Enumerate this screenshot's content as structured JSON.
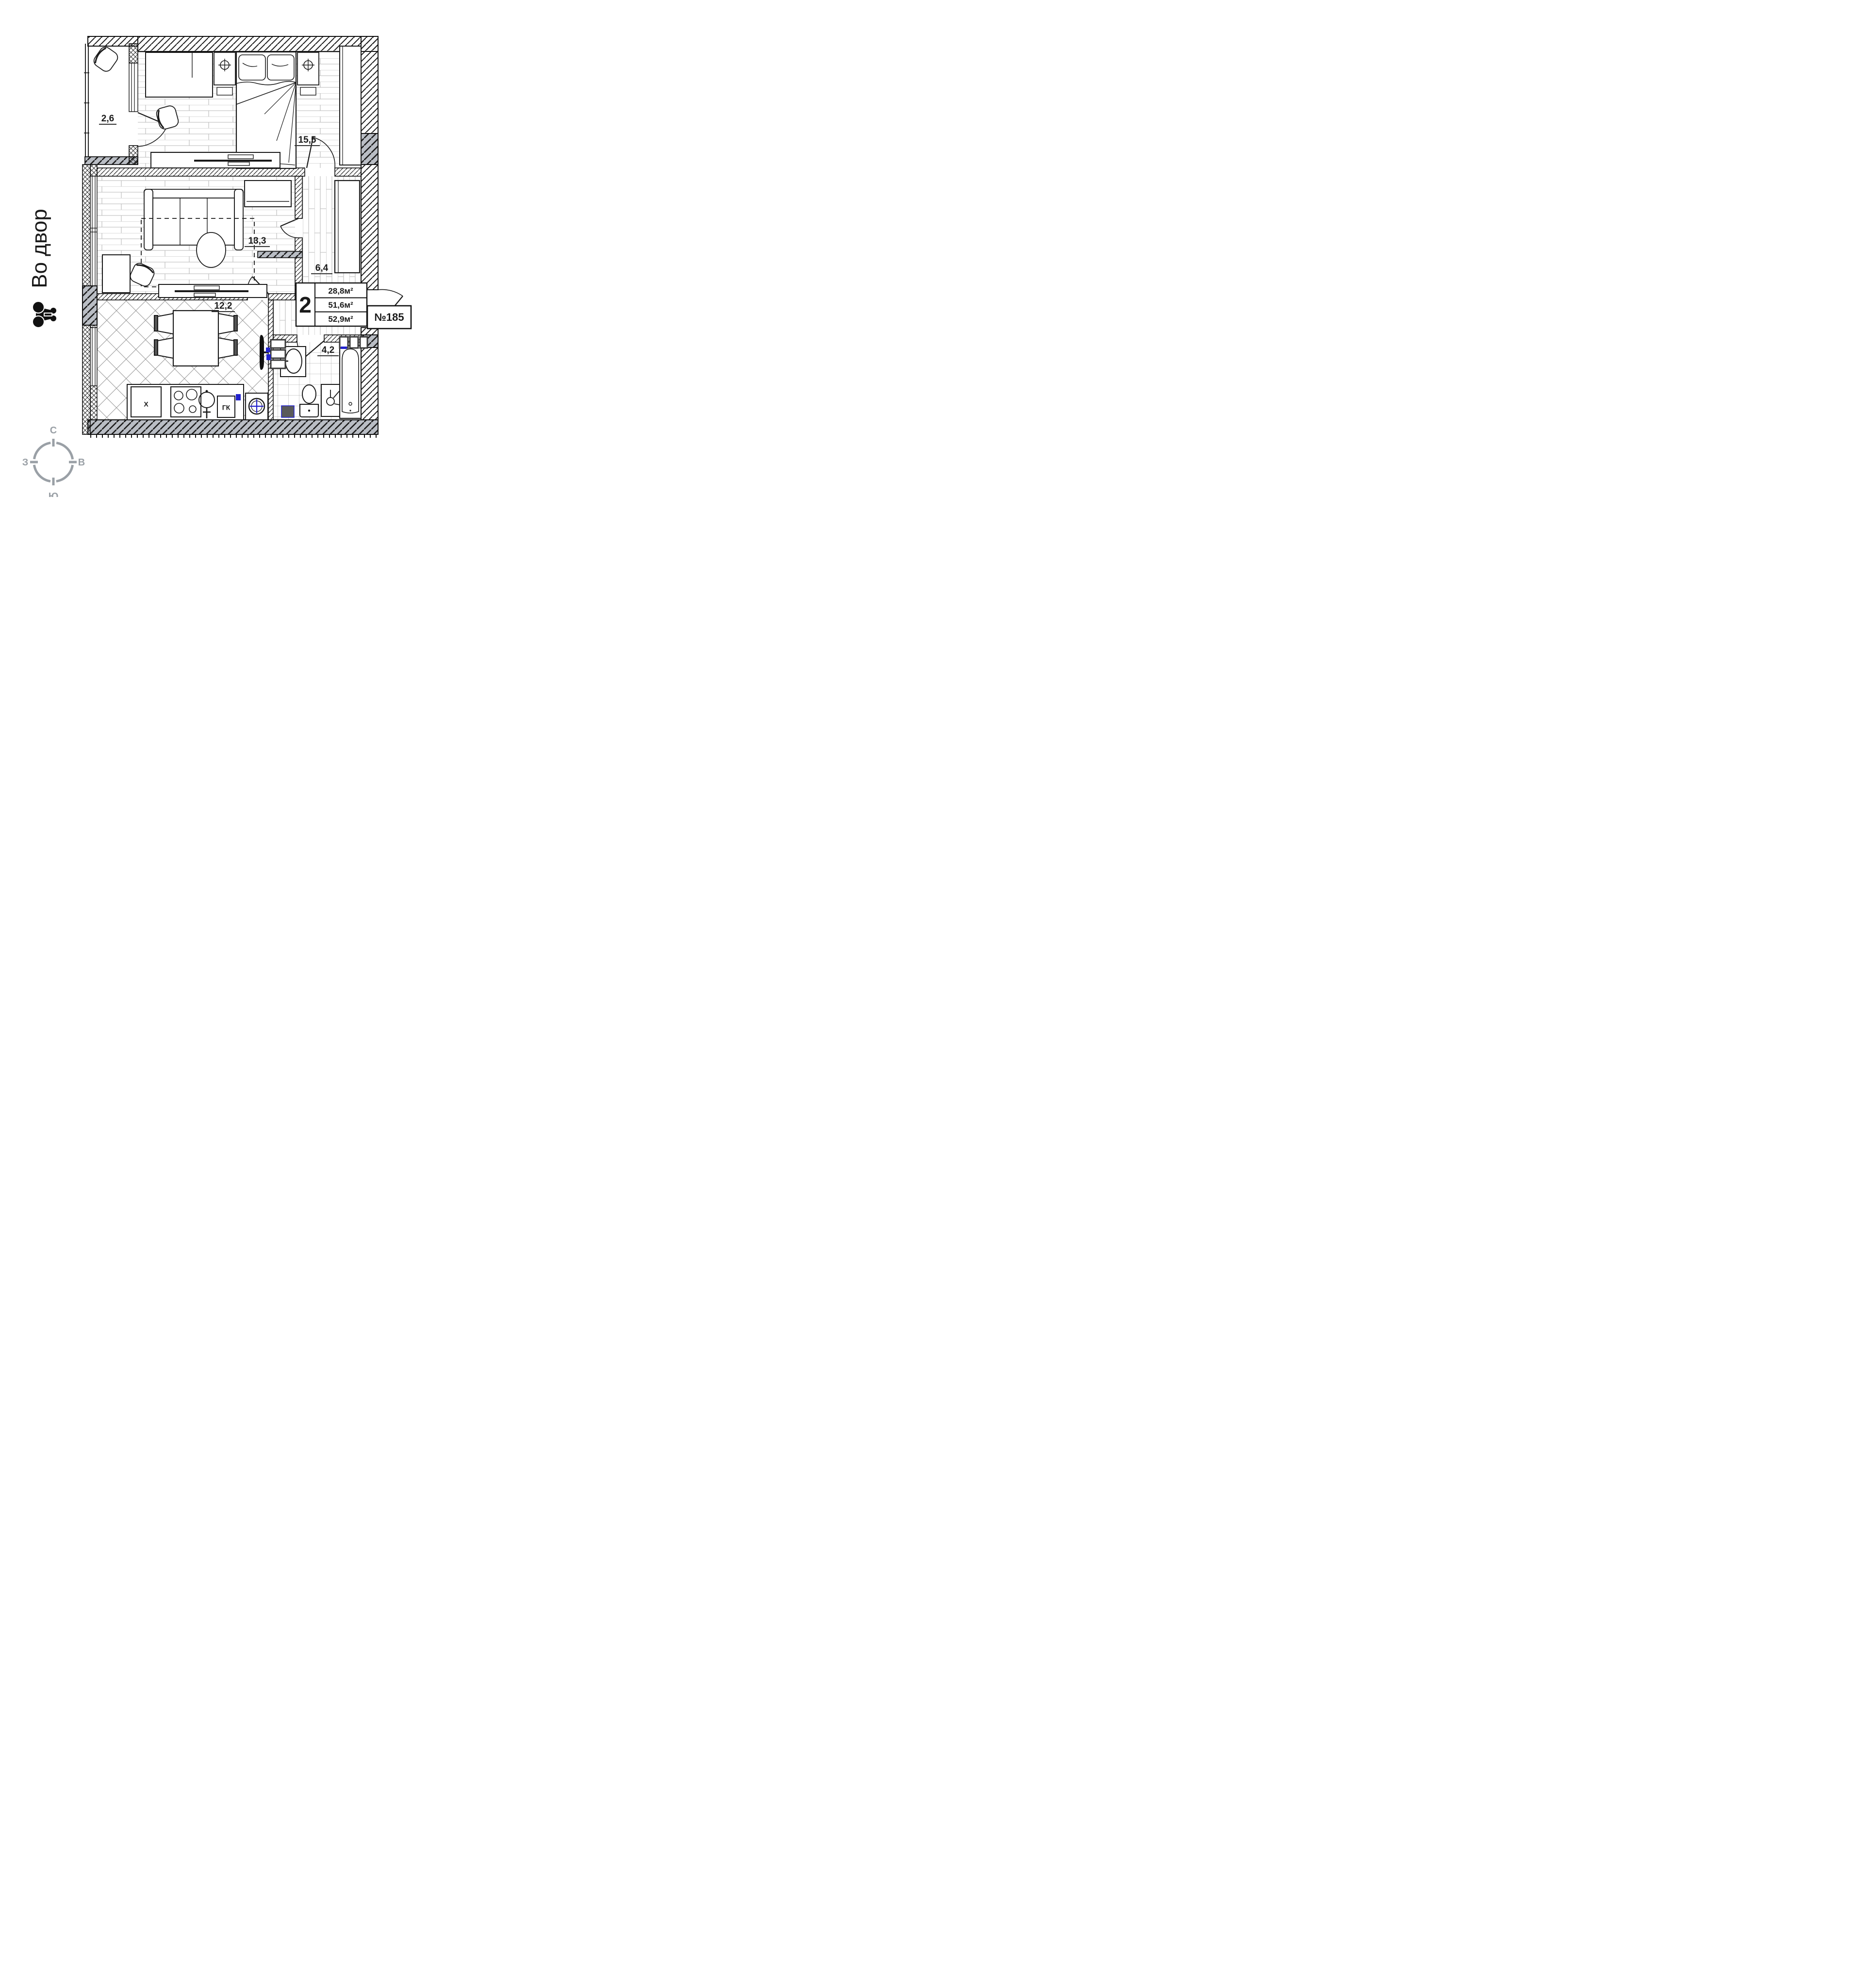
{
  "plan": {
    "annotation": {
      "courtyard_label": "Во двор"
    },
    "apartment_number": "№185",
    "info_block": {
      "rooms_count": "2",
      "living_area": "28,8м²",
      "apartment_area": "51,6м²",
      "total_area": "52,9м²"
    },
    "rooms": [
      {
        "name": "balcony",
        "area": "2,6"
      },
      {
        "name": "bedroom",
        "area": "15,5"
      },
      {
        "name": "living-room",
        "area": "13,3"
      },
      {
        "name": "hallway",
        "area": "6,4"
      },
      {
        "name": "kitchen",
        "area": "12,2"
      },
      {
        "name": "bathroom",
        "area": "4,2"
      }
    ],
    "appliances": {
      "fridge_label": "X",
      "gas_boiler_label": "ГК"
    },
    "compass": {
      "north": "С",
      "south": "Ю",
      "west": "З",
      "east": "В"
    },
    "colors": {
      "accent_blue": "#2222cc",
      "wall_gray": "#b9bdc4",
      "compass_gray": "#9aa0a6"
    }
  }
}
